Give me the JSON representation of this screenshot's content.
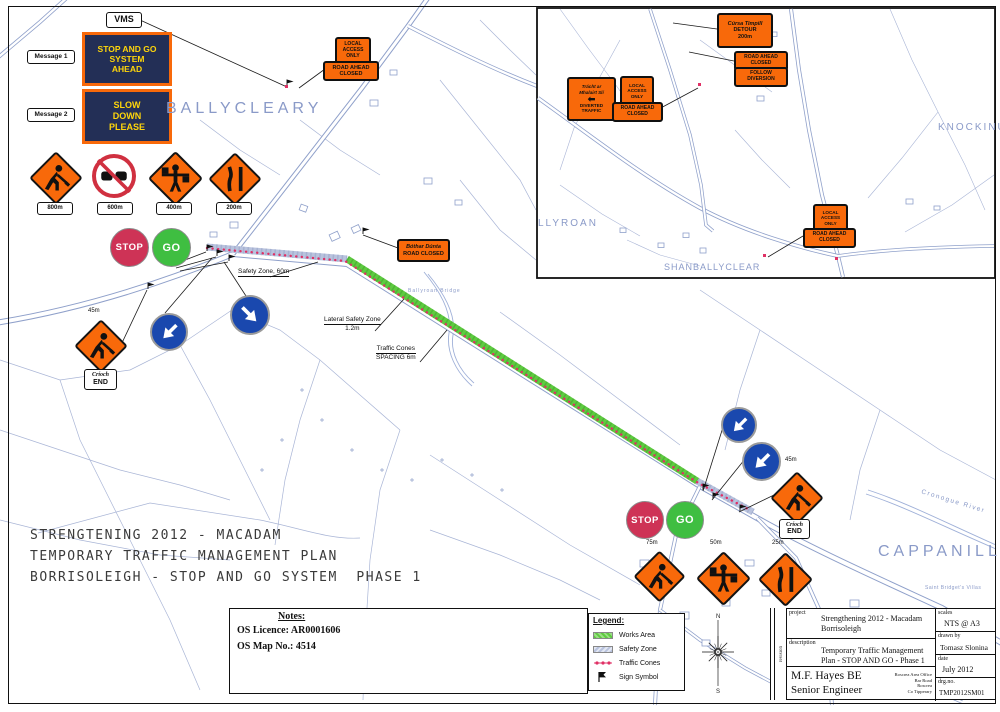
{
  "colors": {
    "sign_orange": "#f8690a",
    "vms_navy": "#232f56",
    "vms_yellow": "#ffd60a",
    "stop_red": "#ce3356",
    "go_green": "#3fbe41",
    "arrow_blue": "#1a48ae",
    "map_line": "#94a3cc",
    "map_text": "#8a9ac8",
    "works_green": "#5ecb40",
    "safety_blue": "#b9c3de",
    "cones_red": "#e03065",
    "ink": "#1c1c1c"
  },
  "vms": {
    "tag": "VMS",
    "message1": "Message 1",
    "message2": "Message 2",
    "board1": [
      "STOP AND GO",
      "SYSTEM",
      "AHEAD"
    ],
    "board2": [
      "SLOW",
      "DOWN",
      "PLEASE"
    ]
  },
  "advance_signs": [
    {
      "icon": "roadworks",
      "distance": "800m"
    },
    {
      "icon": "no-overtaking",
      "distance": "600m"
    },
    {
      "icon": "flagman",
      "distance": "400m"
    },
    {
      "icon": "road-narrows",
      "distance": "200m"
    }
  ],
  "stopgo": {
    "stop": "STOP",
    "go": "GO"
  },
  "map_labels": {
    "safety_zone": "Safety Zone, 60m",
    "lateral1": "Lateral Safety Zone",
    "lateral2": "1.2m",
    "cones1": "Traffic Cones",
    "cones2": "SPACING 6m",
    "d45_left": "45m",
    "d45_right": "45m",
    "d75": "75m",
    "d50": "50m",
    "d25": "25m"
  },
  "crioch": {
    "line1": "Críoch",
    "line2": "END"
  },
  "plates": {
    "local_access": [
      "LOCAL",
      "ACCESS",
      "ONLY"
    ],
    "road_ahead_closed": [
      "ROAD AHEAD",
      "CLOSED"
    ],
    "bothar_dunta": [
      "Bóthar Dúnta",
      "ROAD CLOSED"
    ],
    "detour": [
      "Cúrsa Timpill",
      "DETOUR",
      "200m"
    ],
    "follow_diversion": [
      "FOLLOW",
      "DIVERSION"
    ],
    "diverted_traffic": [
      "Trácht ar",
      "Mhalairt Slí",
      "DIVERTED",
      "TRAFFIC"
    ]
  },
  "places": {
    "ballycleary": "BALLYCLEARY",
    "cappanill": "CAPPANILL",
    "knockinu": "KNOCKINU",
    "llyroan": "LLYROAN",
    "shanballycleary": "SHANBALLYCLEAR",
    "ballyroan_bridge": "Ballyroan Bridge",
    "cronogue_river": "Cronogue River",
    "saint_bridgets": "Saint Bridget's Villas"
  },
  "title_lines": [
    "STRENGTENING 2012 - MACADAM",
    "TEMPORARY TRAFFIC MANAGEMENT PLAN",
    "BORRISOLEIGH - STOP AND GO SYSTEM  PHASE 1"
  ],
  "notes": {
    "heading": "Notes:",
    "licence": "OS Licence: AR0001606",
    "map_no": "OS Map No.: 4514"
  },
  "legend": {
    "heading": "Legend:",
    "works": "Works Area",
    "safety": "Safety Zone",
    "cones": "Traffic Cones",
    "sign": "Sign Symbol"
  },
  "compass": {
    "north": "N",
    "south": "S"
  },
  "titleblock": {
    "revision": "revision",
    "project_label": "project",
    "project1": "Strengthening 2012 - Macadam",
    "project2": "Borrisoleigh",
    "scales_label": "scales",
    "scales": "NTS @ A3",
    "description_label": "description",
    "description1": "Temporary Traffic Management",
    "description2": "Plan - STOP AND GO - Phase 1",
    "drawnby_label": "drawn by",
    "drawnby": "Tomasz Slonina",
    "date_label": "date",
    "date": "July 2012",
    "drg_label": "drg.no.",
    "drg": "TMP2012SM01",
    "engineer1": "M.F. Hayes BE",
    "engineer2": "Senior Engineer",
    "office": [
      "Roscrea Area Office",
      "Bar Road",
      "Roscrea",
      "Co Tipperary"
    ]
  }
}
